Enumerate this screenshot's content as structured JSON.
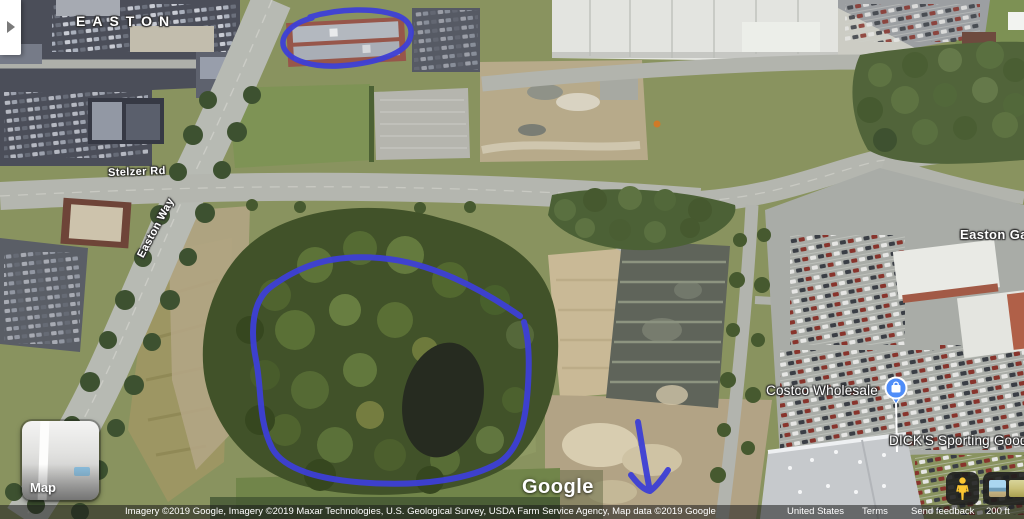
{
  "colors": {
    "annotation_blue": "#3d3fd6",
    "pin_blue": "#4f8df8",
    "pegman_yellow": "#fcc531"
  },
  "icons": {
    "expand_panel": "chevron-right-icon",
    "pegman": "pegman-street-view-icon",
    "poi_pin": "shopping-bag-pin-icon",
    "map_preview": "map-type-thumbnail",
    "photo_thumbnails": [
      "street-photo-thumbnail-sky",
      "street-photo-thumbnail-field"
    ]
  },
  "map_labels": {
    "area_label": "EASTON",
    "area_label_right": "Easton Ga",
    "road_labels": [
      "Stelzer Rd",
      "Easton Way"
    ],
    "poi_labels": [
      "Costco Wholesale",
      "DICK'S Sporting Good"
    ]
  },
  "watermark": "Google",
  "map_type_toggle": "Map",
  "attribution": {
    "imagery_credits": "Imagery ©2019 Google, Imagery ©2019 Maxar Technologies, U.S. Geological Survey, USDA Farm Service Agency, Map data ©2019 Google",
    "region": "United States",
    "terms_link": "Terms",
    "feedback_link": "Send feedback",
    "scale_text": "200 ft"
  },
  "annotations": {
    "color": "#3d3fd6",
    "shapes": [
      "hand-drawn ellipse around office building (top center)",
      "hand-drawn loop around wooded pond parcel (center)",
      "hand-drawn arrow pointing down (bottom center)"
    ]
  }
}
